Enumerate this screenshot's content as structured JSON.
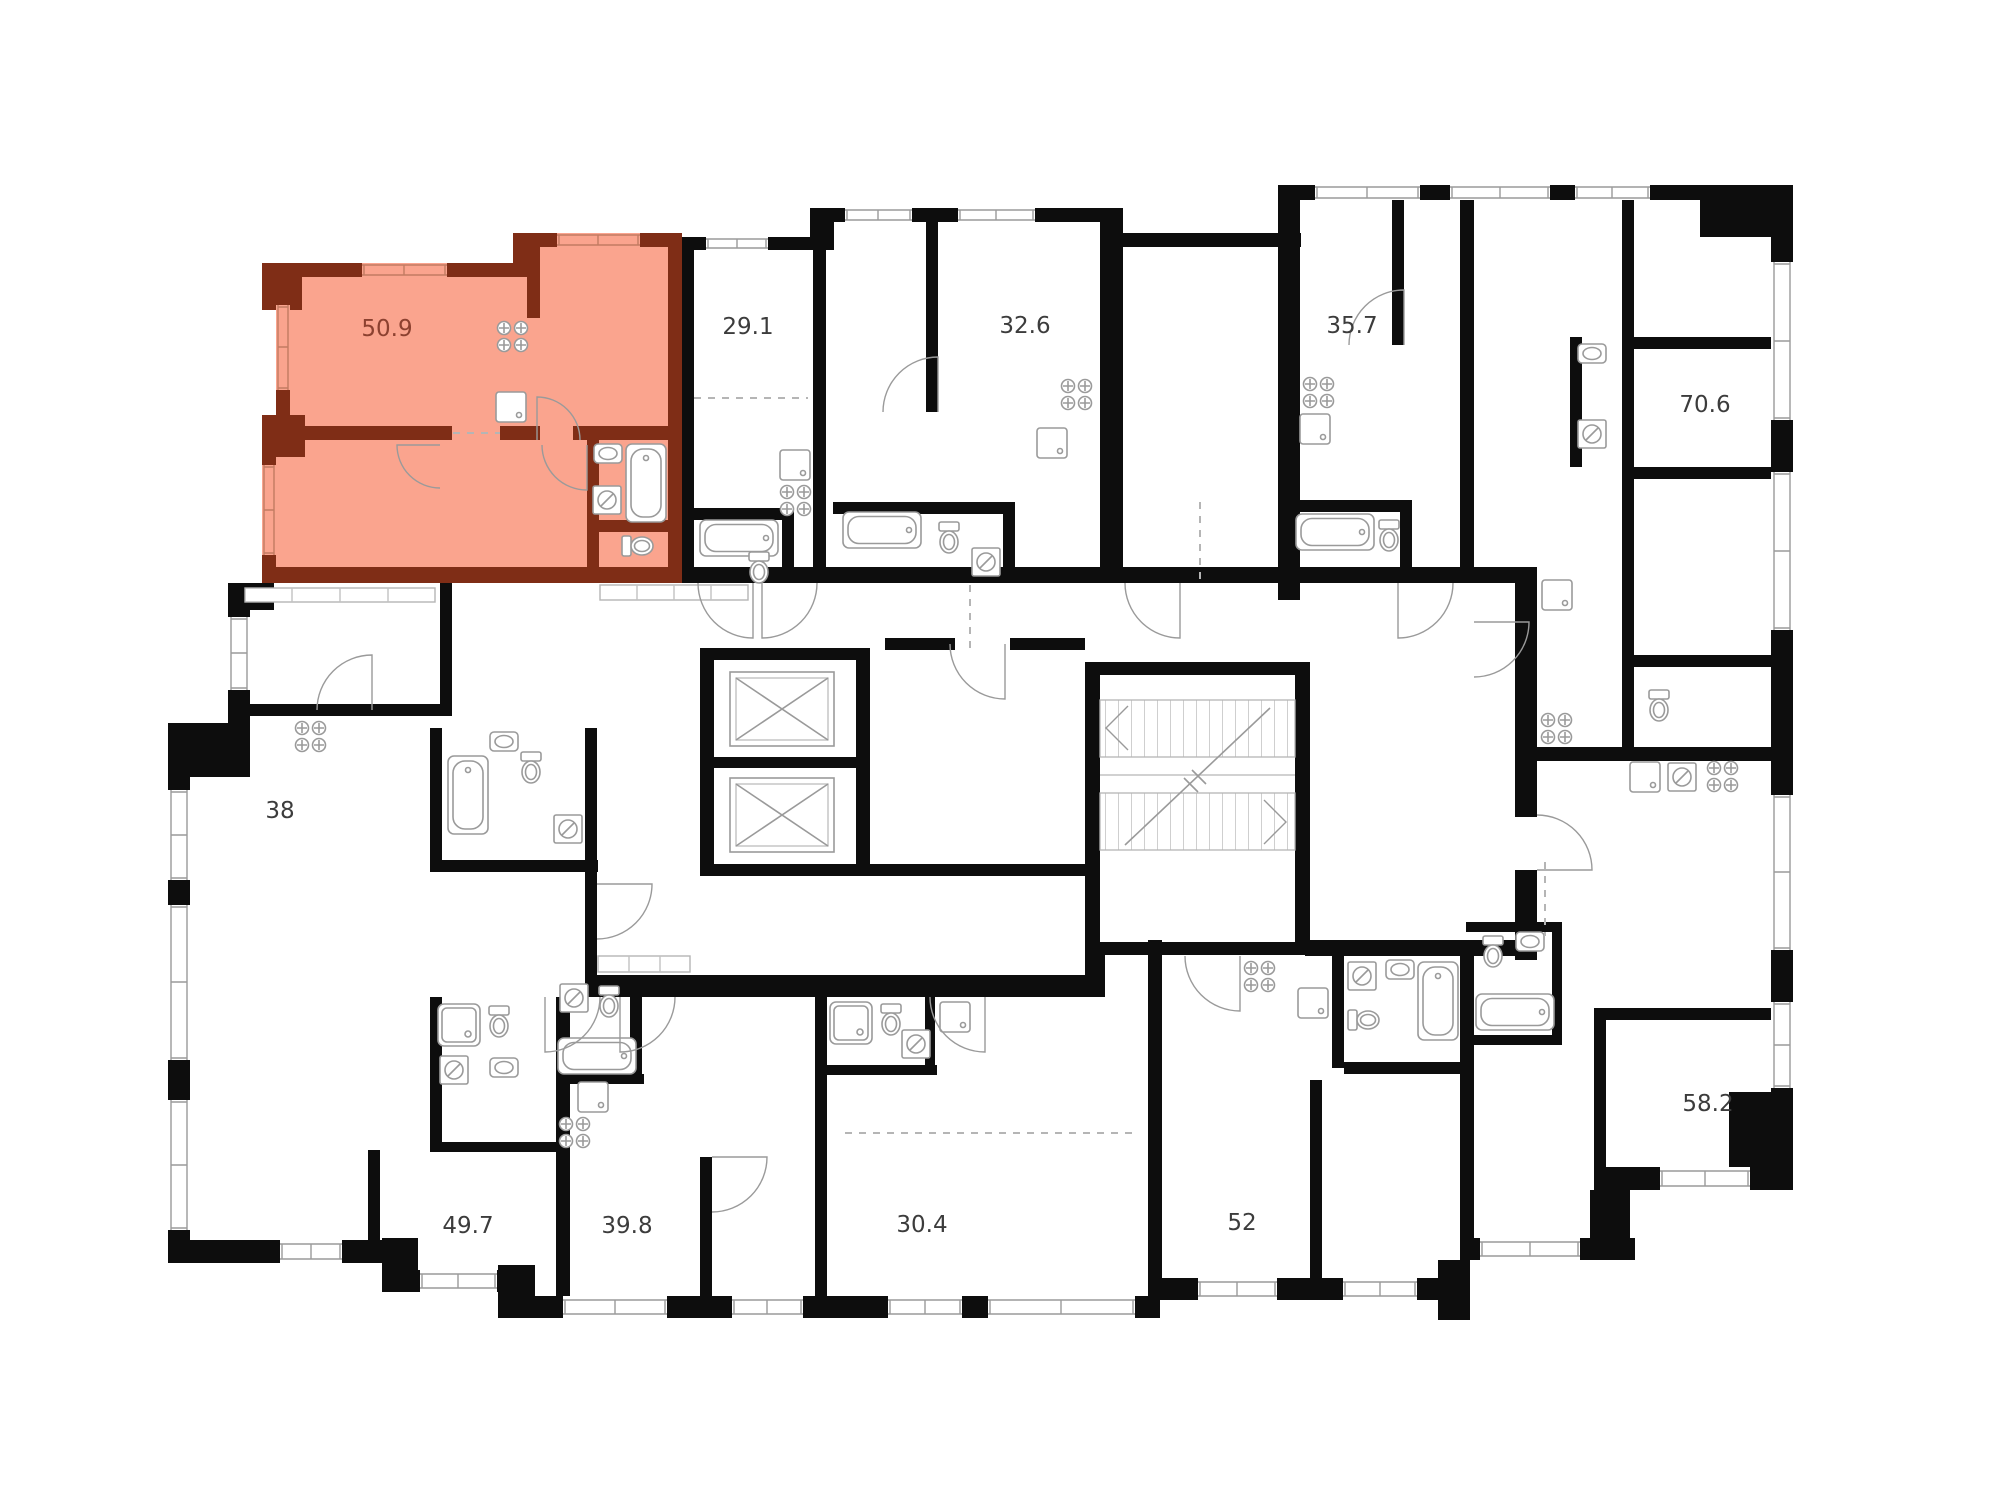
{
  "plan": {
    "type": "residential-floor-plan",
    "selected_unit": "50.9"
  },
  "colors": {
    "bg": "#ffffff",
    "wall": "#0d0d0d",
    "highlight_fill": "#faa48e",
    "highlight_wall": "#7f2d16",
    "highlight_text": "#8c4130",
    "line": "#9a9a9a",
    "line_light": "#c2c2c2",
    "label_text": "#3c3c3c"
  },
  "units": [
    {
      "id": "unit-50-9",
      "label": "50.9",
      "highlighted": true
    },
    {
      "id": "unit-29-1",
      "label": "29.1",
      "highlighted": false
    },
    {
      "id": "unit-32-6",
      "label": "32.6",
      "highlighted": false
    },
    {
      "id": "unit-35-7",
      "label": "35.7",
      "highlighted": false
    },
    {
      "id": "unit-70-6",
      "label": "70.6",
      "highlighted": false
    },
    {
      "id": "unit-38",
      "label": "38",
      "highlighted": false
    },
    {
      "id": "unit-49-7",
      "label": "49.7",
      "highlighted": false
    },
    {
      "id": "unit-39-8",
      "label": "39.8",
      "highlighted": false
    },
    {
      "id": "unit-30-4",
      "label": "30.4",
      "highlighted": false
    },
    {
      "id": "unit-52",
      "label": "52",
      "highlighted": false
    },
    {
      "id": "unit-58-2",
      "label": "58.2",
      "highlighted": false
    }
  ],
  "icons": {
    "stove": "stove-icon",
    "sink": "sink-icon",
    "bathtub": "bathtub-icon",
    "toilet": "toilet-icon",
    "washer": "washing-machine-icon",
    "shower": "shower-icon",
    "elevator": "elevator-icon",
    "stairs": "stairs-icon",
    "door": "door-arc-icon",
    "window": "window-icon"
  }
}
